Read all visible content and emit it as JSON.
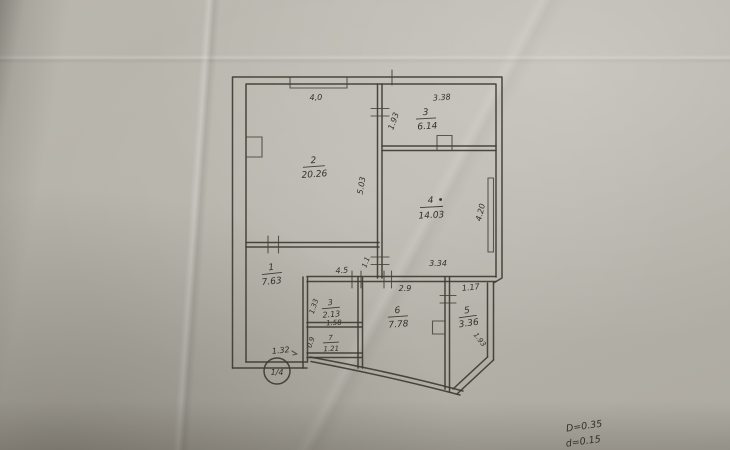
{
  "photo": {
    "description": "scanned hand-drawn apartment floor plan on creased grey paper",
    "colors": {
      "paper": "#b6b3aa",
      "ink": "#3e3b32",
      "handwriting": "#33302a",
      "shadow": "#8a877e"
    }
  },
  "rooms": [
    {
      "key": "room-1",
      "number": "1",
      "area": "7.63"
    },
    {
      "key": "room-2",
      "number": "2",
      "area": "20.26"
    },
    {
      "key": "room-3-top",
      "number": "3",
      "area": "6.14"
    },
    {
      "key": "room-4",
      "number": "4",
      "area": "14.03"
    },
    {
      "key": "room-5",
      "number": "5",
      "area": "3.36"
    },
    {
      "key": "room-6",
      "number": "6",
      "area": "7.78"
    },
    {
      "key": "room-3-small",
      "number": "3",
      "area": "2.13"
    },
    {
      "key": "room-7",
      "number": "7",
      "area": "1.21"
    }
  ],
  "dims": {
    "room2_top": "4,0",
    "room2_side": "5.03",
    "room3_top": "3.38",
    "room3_side": "1.93",
    "room4_side": "4.20",
    "room4_bottom": "3.34",
    "hall_width": "4.5",
    "door_width": "1.1",
    "room6_top": "2.9",
    "room5_top": "1.17",
    "room5_diag": "1.93",
    "room3s_side": "1.33",
    "room3s_width": "1.58",
    "room7_side": "0.9",
    "entry": "1.32",
    "riser_mark": "1/4"
  },
  "notes": {
    "line1": "D=0.35",
    "line2": "d=0.15"
  }
}
